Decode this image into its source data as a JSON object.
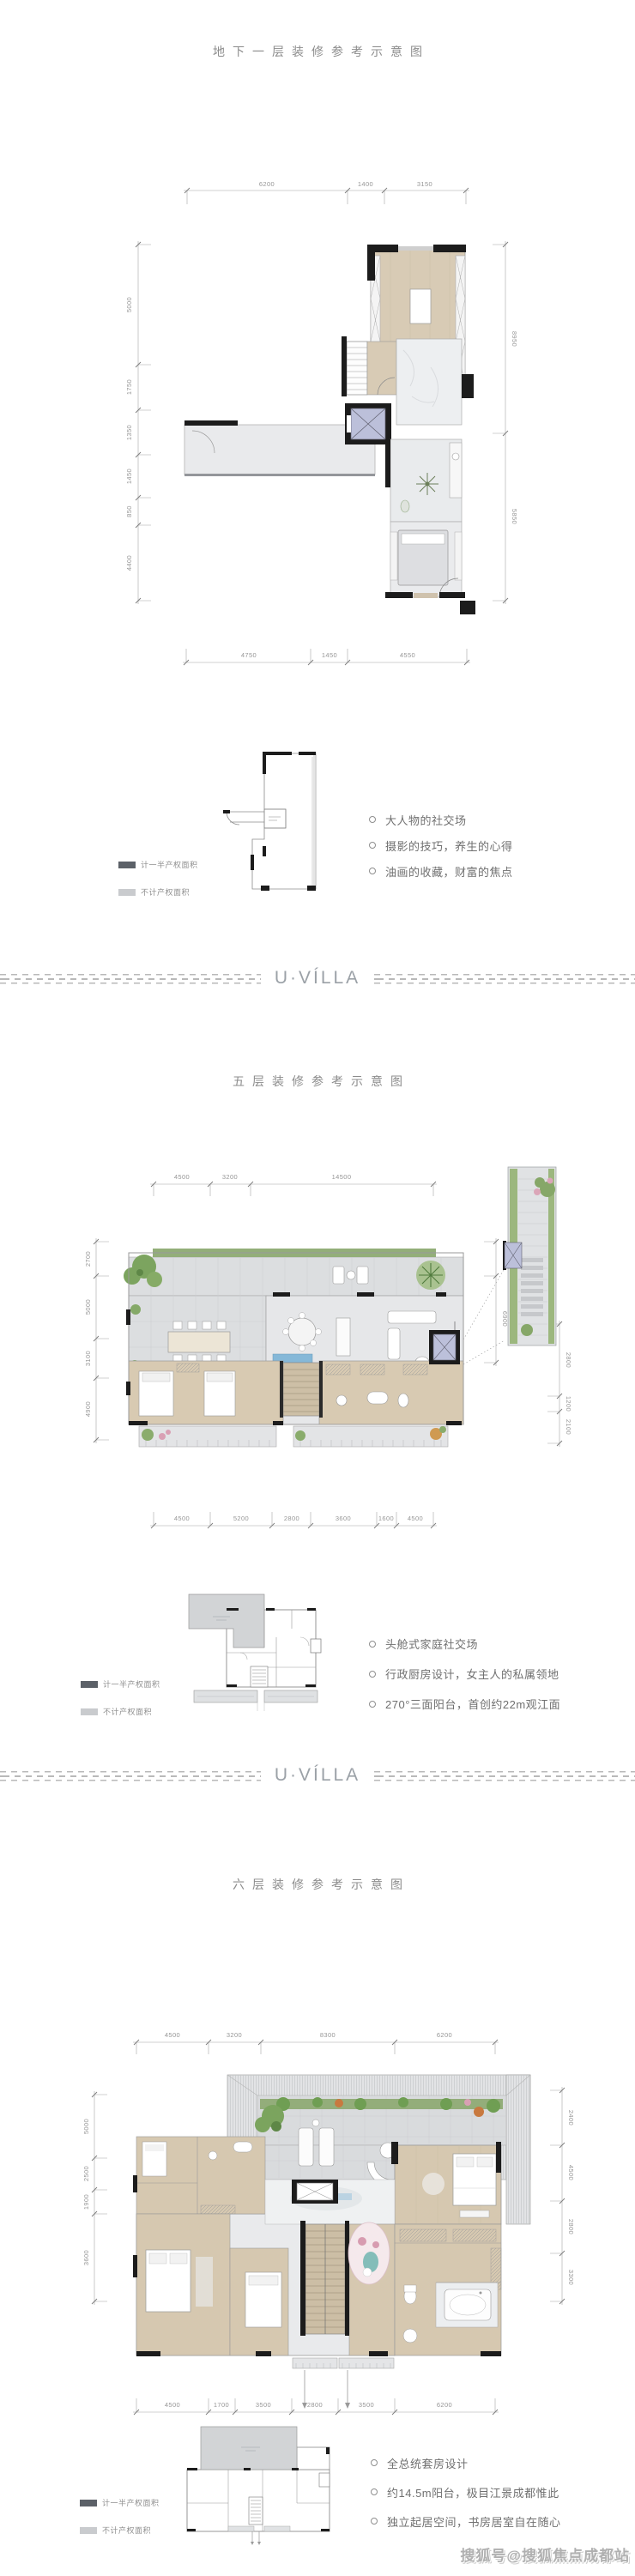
{
  "watermark": "搜狐号@搜狐焦点成都站",
  "divider": {
    "logo": "U·VÍLLA"
  },
  "legend": {
    "items": [
      {
        "name": "half-property-area",
        "label": "计一半产权面积",
        "swatch_color": "#5c6168"
      },
      {
        "name": "non-property-area",
        "label": "不计产权面积",
        "swatch_color": "#c9cbce"
      }
    ]
  },
  "colors": {
    "wood_floor": "#d8cbb5",
    "tile_floor": "#dcdee0",
    "marble_floor": "#edeff1",
    "wall": "#1c1c1c",
    "elevator": "#bcc0da",
    "greenery": "#7ca45f",
    "dim_text": "#969696",
    "title_text": "#8c8c8c"
  },
  "sections": [
    {
      "title": "地下一层装修参考示意图",
      "plan": {
        "top_dims": [
          "6200",
          "1400",
          "3150"
        ],
        "left_dims": [
          "5000",
          "1750",
          "1350",
          "1450",
          "850",
          "4400"
        ],
        "right_dims": [
          "8950",
          "5850"
        ],
        "bottom_dims": [
          "4750",
          "1450",
          "4550"
        ]
      },
      "bullets": [
        "大人物的社交场",
        "摄影的技巧，养生的心得",
        "油画的收藏，财富的焦点"
      ]
    },
    {
      "title": "五层装修参考示意图",
      "plan": {
        "top_dims": [
          "4500",
          "3200",
          "14500"
        ],
        "left_dims": [
          "2700",
          "5000",
          "3100",
          "4900"
        ],
        "right_dims": [
          "2700",
          "6900",
          "2800",
          "1200",
          "2100"
        ],
        "bottom_dims": [
          "4500",
          "5200",
          "2800",
          "3600",
          "1600",
          "4500"
        ]
      },
      "bullets": [
        "头舱式家庭社交场",
        "行政厨房设计，女主人的私属领地",
        "270°三面阳台，首创约22m观江面"
      ]
    },
    {
      "title": "六层装修参考示意图",
      "plan": {
        "top_dims": [
          "4500",
          "3200",
          "8300",
          "6200"
        ],
        "left_dims": [
          "5000",
          "2500",
          "1900",
          "3600"
        ],
        "right_dims": [
          "2400",
          "4500",
          "2800",
          "3300"
        ],
        "bottom_dims": [
          "4500",
          "1700",
          "3500",
          "2800",
          "3500",
          "6200"
        ]
      },
      "bullets": [
        "全总统套房设计",
        "约14.5m阳台，极目江景成都惟此",
        "独立起居空间，书房居室自在随心"
      ]
    }
  ]
}
